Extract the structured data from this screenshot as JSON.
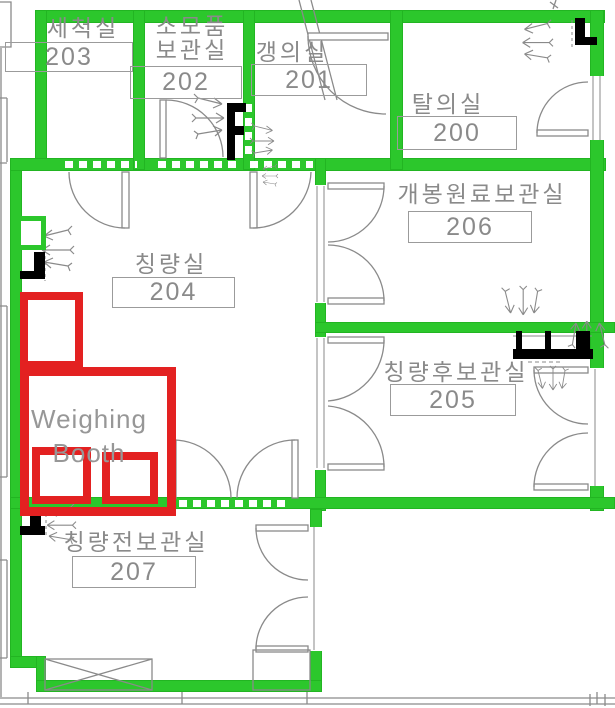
{
  "plan_title": "weighing-area-floor-plan",
  "colors": {
    "wall_green": "#2cc72c",
    "highlight_red": "#e32121",
    "line_gray": "#8a8a8a",
    "text_gray": "#8a8a8a",
    "fixture_black": "#000000"
  },
  "rooms": [
    {
      "name": "세척실",
      "number": "203"
    },
    {
      "name_line1": "소모품",
      "name_line2": "보관실",
      "number": "202"
    },
    {
      "name": "갱의실",
      "number": "201"
    },
    {
      "name": "탈의실",
      "number": "200"
    },
    {
      "name": "칭량실",
      "number": "204"
    },
    {
      "name": "개봉원료보관실",
      "number": "206"
    },
    {
      "name": "칭량후보관실",
      "number": "205"
    },
    {
      "name": "칭량전보관실",
      "number": "207"
    }
  ],
  "highlight": {
    "label_line1": "Weighing",
    "label_line2": "Booth"
  }
}
